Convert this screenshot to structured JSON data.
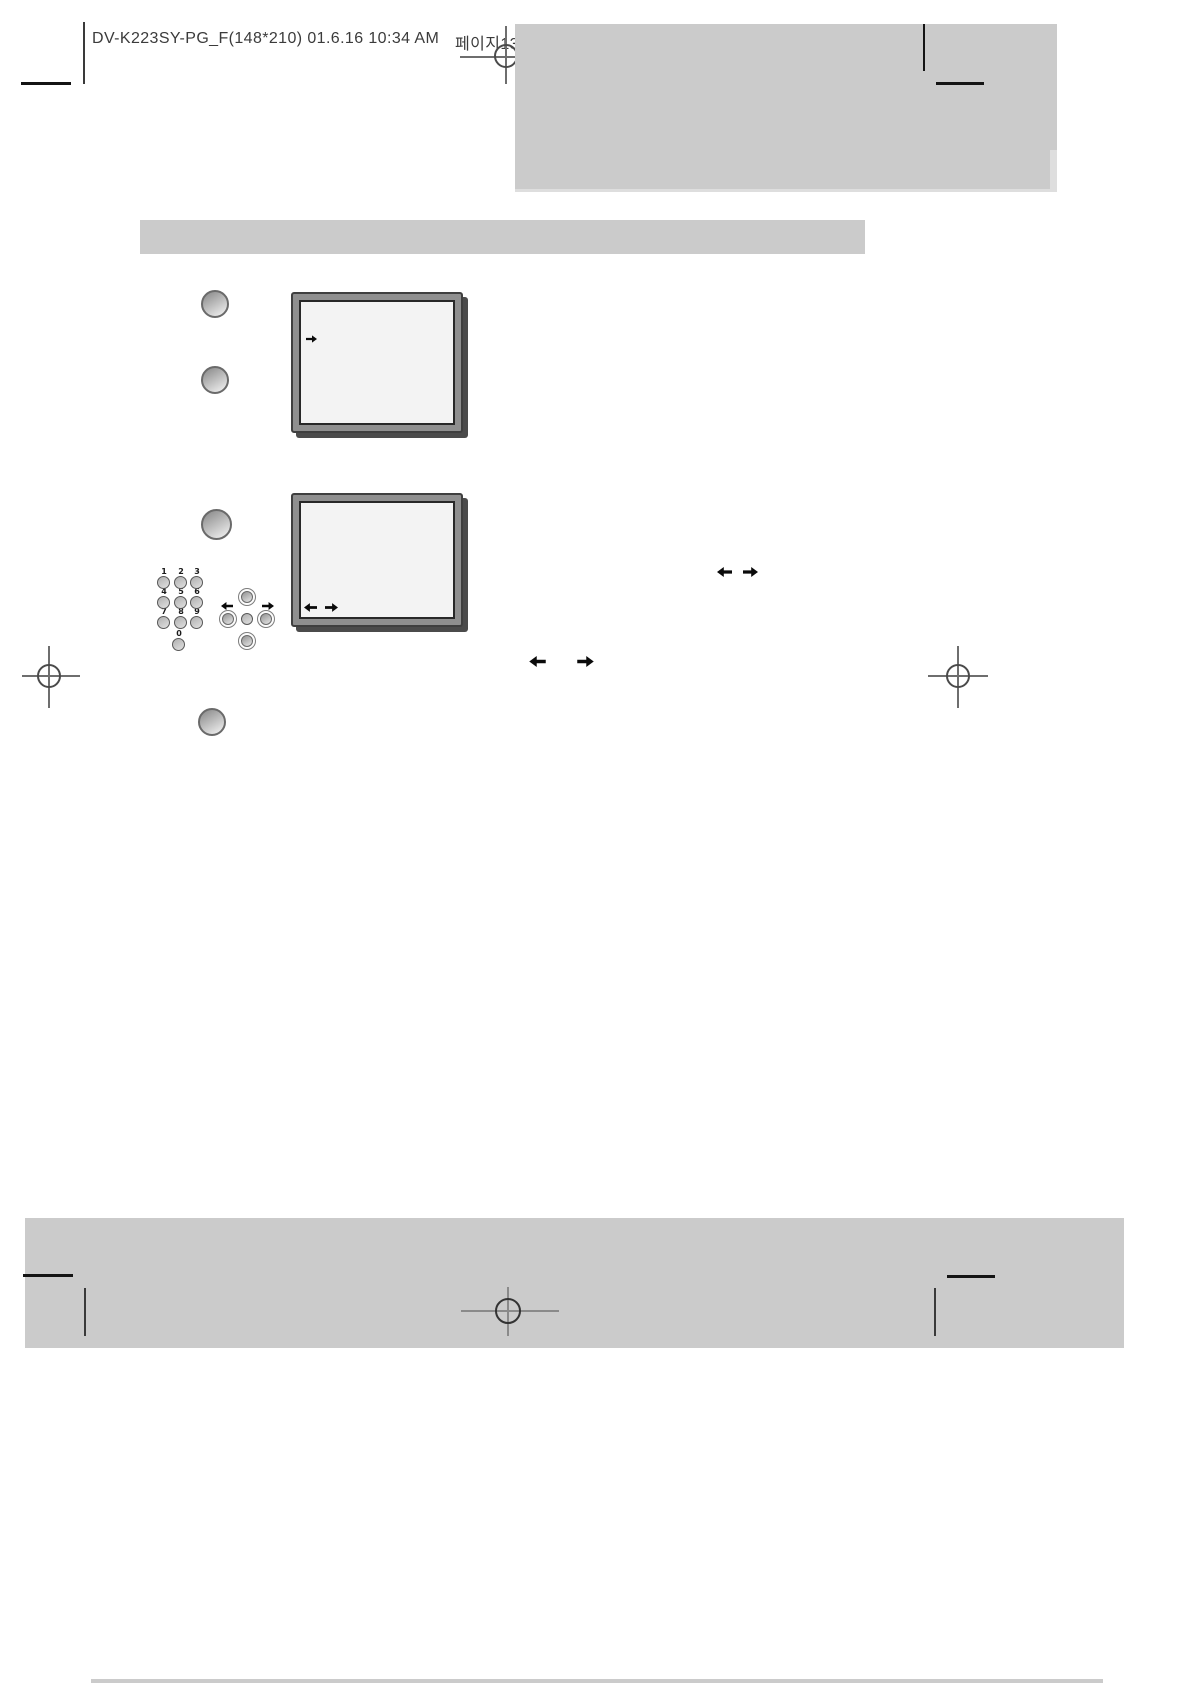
{
  "document": {
    "header": {
      "file_info": "DV-K223SY-PG_F(148*210)  01.6.16 10:34 AM",
      "page_label": "페이지13"
    },
    "remote_keypad": {
      "digits": [
        "1",
        "2",
        "3",
        "4",
        "5",
        "6",
        "7",
        "8",
        "9",
        "0"
      ]
    },
    "icons": {
      "screen1_arrow": "right-arrow",
      "screen2_arrow_left": "left-arrow",
      "screen2_arrow_right": "right-arrow",
      "inline_pair1_left": "left-arrow",
      "inline_pair1_right": "right-arrow",
      "inline_pair2_left": "left-arrow",
      "inline_pair2_right": "right-arrow",
      "dpad_arrow_left": "left-arrow",
      "dpad_arrow_right": "right-arrow"
    },
    "colors": {
      "placeholder_gray": "#cbcbcb",
      "tv_frame": "#8f8f8f",
      "tv_screen": "#f3f3f3",
      "tv_shadow": "#4b4b4b",
      "registration_ink": "#141414",
      "crosshair_gray": "#6e6e6e"
    }
  }
}
